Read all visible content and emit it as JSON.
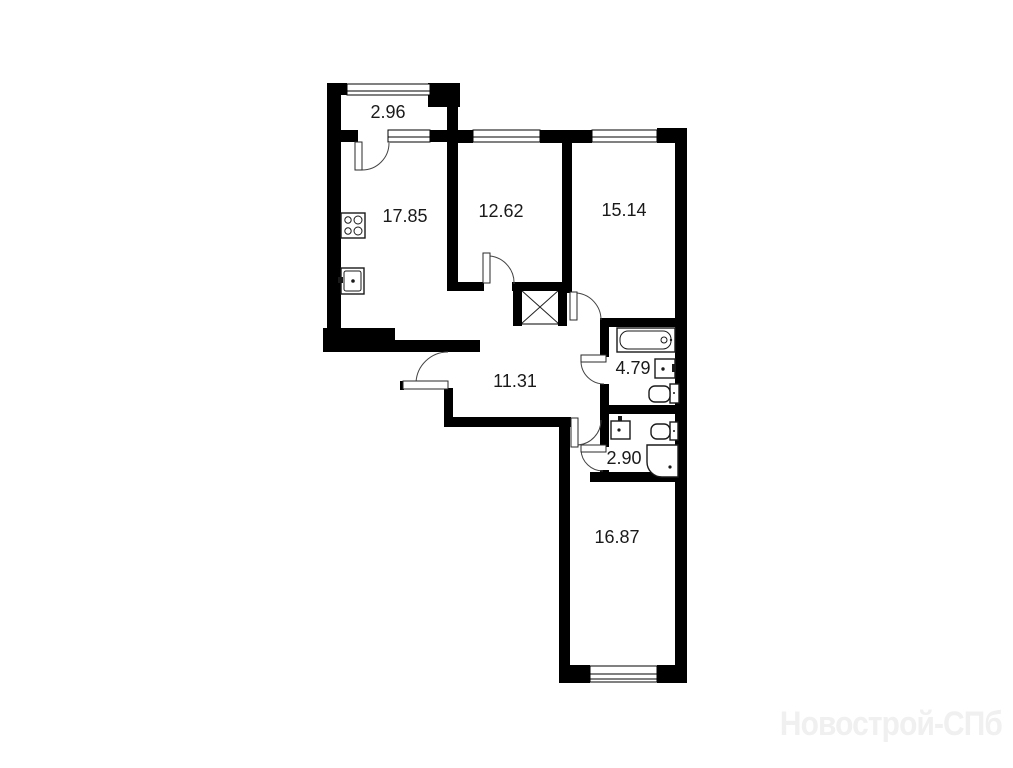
{
  "floor_plan": {
    "type": "apartment-floor-plan",
    "room_areas": {
      "balcony": "2.96",
      "kitchen_living": "17.85",
      "room_1": "12.62",
      "room_2": "15.14",
      "hallway": "11.31",
      "bathroom": "4.79",
      "wc": "2.90",
      "room_3": "16.87"
    },
    "watermark": "Новострой-СПб",
    "colors": {
      "wall": "#000000",
      "door_line": "#444444",
      "label": "#1a1a1a",
      "watermark": "#f0f0f0",
      "background": "#ffffff"
    },
    "fixtures": [
      "stove-icon",
      "kitchen-sink-icon",
      "bathtub-icon",
      "washbasin-icon",
      "toilet-icon",
      "shower-cabin-icon",
      "ventilation-shaft-icon"
    ]
  }
}
